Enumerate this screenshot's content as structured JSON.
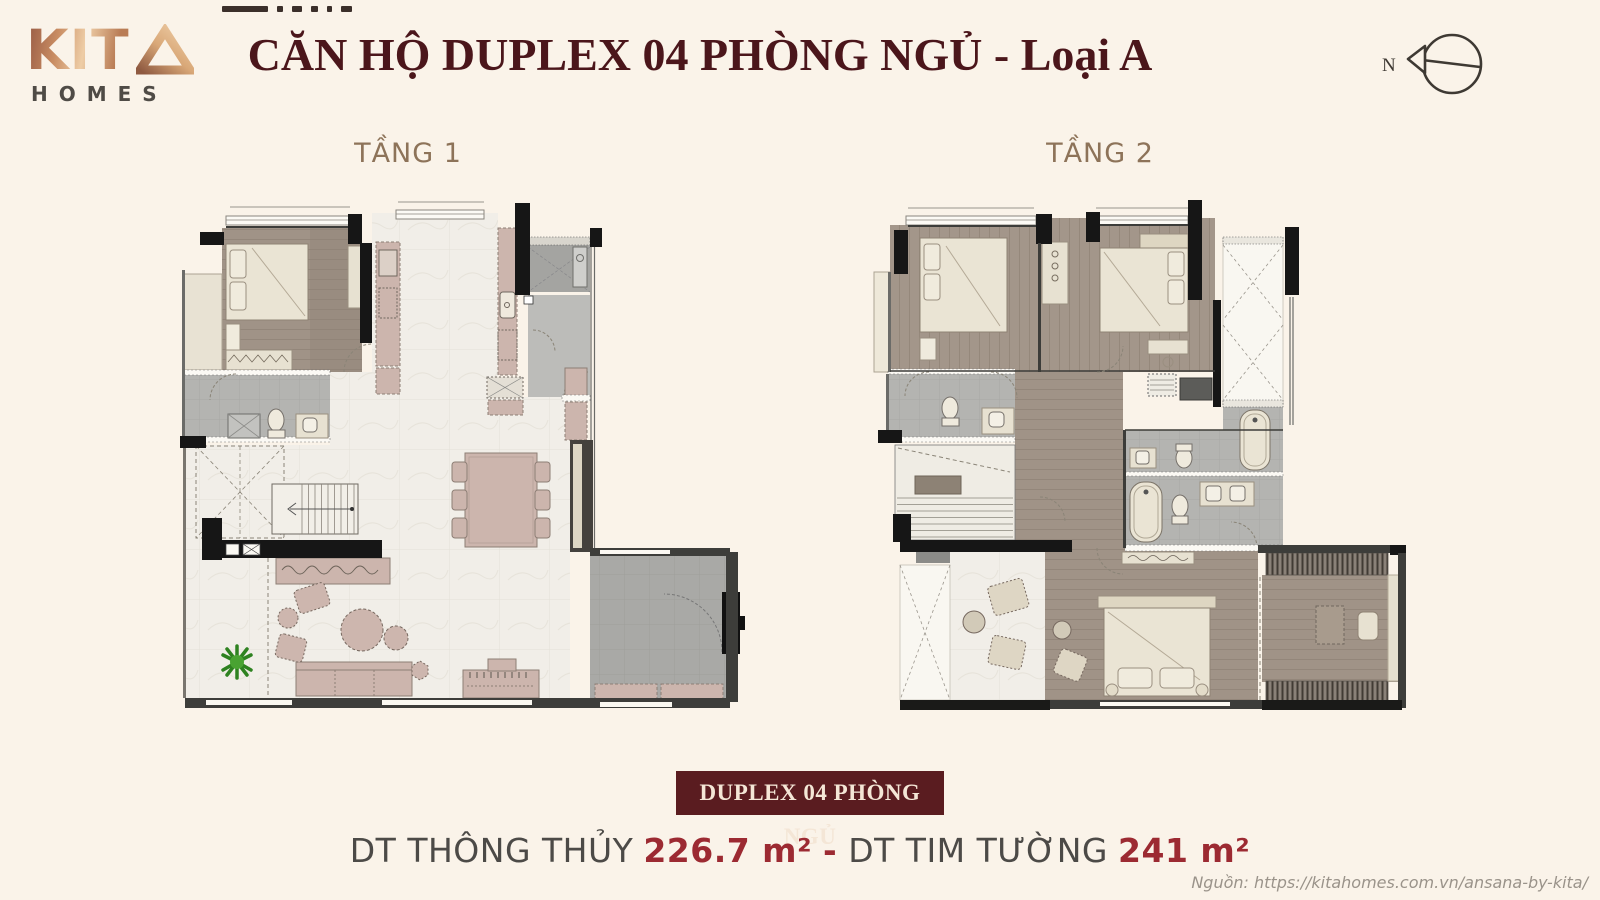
{
  "page": {
    "background": "#faf3e9",
    "width": 1600,
    "height": 900
  },
  "logo": {
    "kit": "KIT",
    "triangle_icon": "penrose-triangle",
    "homes": "HOMES"
  },
  "header": {
    "title": "CĂN HỘ DUPLEX 04 PHÒNG NGỦ - Loại A",
    "title_color": "#4b161b",
    "compass_label": "N"
  },
  "floors": [
    {
      "label": "TẦNG 1"
    },
    {
      "label": "TẦNG 2"
    }
  ],
  "footer": {
    "badge": "DUPLEX 04 PHÒNG NGỦ",
    "badge_bg": "#5a1c20",
    "area_label_1": "DT THÔNG THỦY",
    "area_value_1": "226.7 m²",
    "separator": "-",
    "area_label_2": "DT TIM TƯỜNG",
    "area_value_2": "241 m²",
    "accent_color": "#9c2a32",
    "source": "Nguồn: https://kitahomes.com.vn/ansana-by-kita/"
  }
}
